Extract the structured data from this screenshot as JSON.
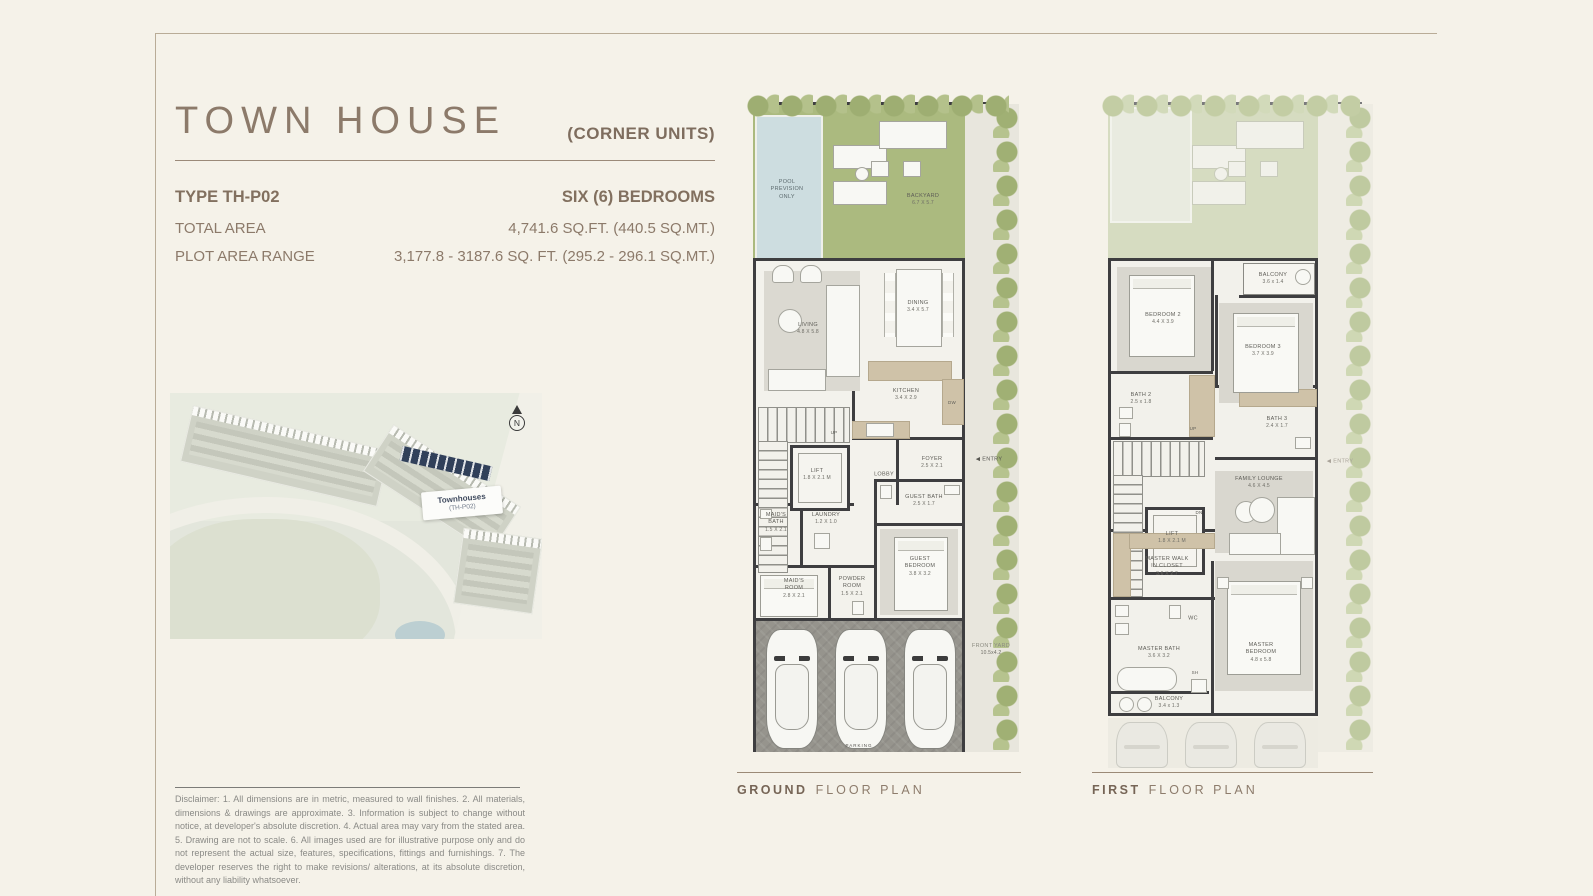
{
  "palette": {
    "accent_brown": "#8c7a6a",
    "backyard_green": "#abba7f",
    "pool_blue": "#cddde0",
    "wall_dark": "#3e3e40",
    "map_highlight_navy": "#31405a",
    "page_bg": "#f5f2e9"
  },
  "header": {
    "title": "TOWN HOUSE",
    "units_note": "(CORNER UNITS)"
  },
  "specs": {
    "type": "TYPE TH-P02",
    "bedrooms": "SIX (6) BEDROOMS",
    "total_area_label": "TOTAL AREA",
    "total_area_value": "4,741.6 SQ.FT. (440.5 SQ.MT.)",
    "plot_area_label": "PLOT AREA RANGE",
    "plot_area_value": "3,177.8 - 3187.6 SQ. FT. (295.2 - 296.1 SQ.MT.)"
  },
  "site_map": {
    "label": "Townhouses",
    "sublabel": "(TH-P02)",
    "compass": "N"
  },
  "ground_floor": {
    "caption_bold": "GROUND",
    "caption_rest": "FLOOR PLAN",
    "rooms": {
      "pool": {
        "label": "POOL PREVISION ONLY"
      },
      "backyard": {
        "label": "BACKYARD",
        "dim": "6.7 X 5.7"
      },
      "living": {
        "label": "LIVING",
        "dim": "4.8 X 5.8"
      },
      "dining": {
        "label": "DINING",
        "dim": "3.4 X 5.7"
      },
      "kitchen": {
        "label": "KITCHEN",
        "dim": "3.4 X 2.9"
      },
      "dw": {
        "label": "DW"
      },
      "lift": {
        "label": "LIFT",
        "dim": "1.8 X 2.1 M"
      },
      "lobby": {
        "label": "LOBBY"
      },
      "foyer": {
        "label": "FOYER",
        "dim": "2.5 X 2.1"
      },
      "up": {
        "label": "UP"
      },
      "entry": {
        "arrow": "◀",
        "label": "ENTRY"
      },
      "maids_bath": {
        "label": "MAID'S BATH",
        "dim": "1.5 X 2.1"
      },
      "laundry": {
        "label": "LAUNDRY",
        "dim": "1.2 X 1.0"
      },
      "guest_bath": {
        "label": "GUEST BATH",
        "dim": "2.5 X 1.7"
      },
      "maids_room": {
        "label": "MAID'S ROOM",
        "dim": "2.8 X 2.1"
      },
      "powder_room": {
        "label": "POWDER ROOM",
        "dim": "1.5 X 2.1"
      },
      "guest_bedroom": {
        "label": "GUEST BEDROOM",
        "dim": "3.8 X 3.2"
      },
      "front_yard": {
        "label": "FRONT YARD",
        "dim": "10.5x4.2"
      },
      "parking": {
        "label": "PARKING"
      }
    }
  },
  "first_floor": {
    "caption_bold": "FIRST",
    "caption_rest": "FLOOR PLAN",
    "rooms": {
      "balcony_top": {
        "label": "BALCONY",
        "dim": "3.6 x 1.4"
      },
      "bedroom2": {
        "label": "BEDROOM 2",
        "dim": "4.4 X 3.9"
      },
      "bedroom3": {
        "label": "BEDROOM 3",
        "dim": "3.7 X 3.9"
      },
      "bath2": {
        "label": "BATH 2",
        "dim": "2.5 x 1.8"
      },
      "bath3": {
        "label": "BATH 3",
        "dim": "2.4 X 1.7"
      },
      "up": {
        "label": "UP"
      },
      "dn": {
        "label": "DN"
      },
      "lift": {
        "label": "LIFT",
        "dim": "1.8 X 2.1 M"
      },
      "family_lounge": {
        "label": "FAMILY LOUNGE",
        "dim": "4.6 X 4.5"
      },
      "master_closet": {
        "label": "MASTER WALK IN CLOSET",
        "dim": "3.6 X 2.7"
      },
      "wc": {
        "label": "WC"
      },
      "master_bath": {
        "label": "MASTER BATH",
        "dim": "3.6 X 3.2"
      },
      "sh": {
        "label": "SH"
      },
      "master_bedroom": {
        "label": "MASTER BEDROOM",
        "dim": "4.8 x 5.8"
      },
      "balcony_bottom": {
        "label": "BALCONY",
        "dim": "3.4 x 1.3"
      },
      "entry": {
        "arrow": "◀",
        "label": "ENTRY"
      }
    }
  },
  "disclaimer": "Disclaimer: 1. All dimensions are in metric, measured to wall finishes. 2. All materials, dimensions & drawings are approximate. 3. Information is subject to change without notice, at developer's absolute discretion. 4. Actual area may vary from the stated area. 5. Drawing are not to scale. 6. All images used are for illustrative purpose only and do not represent the actual size, features, specifications, fittings and furnishings. 7. The developer reserves the right to make revisions/ alterations, at its absolute discretion, without any liability whatsoever."
}
